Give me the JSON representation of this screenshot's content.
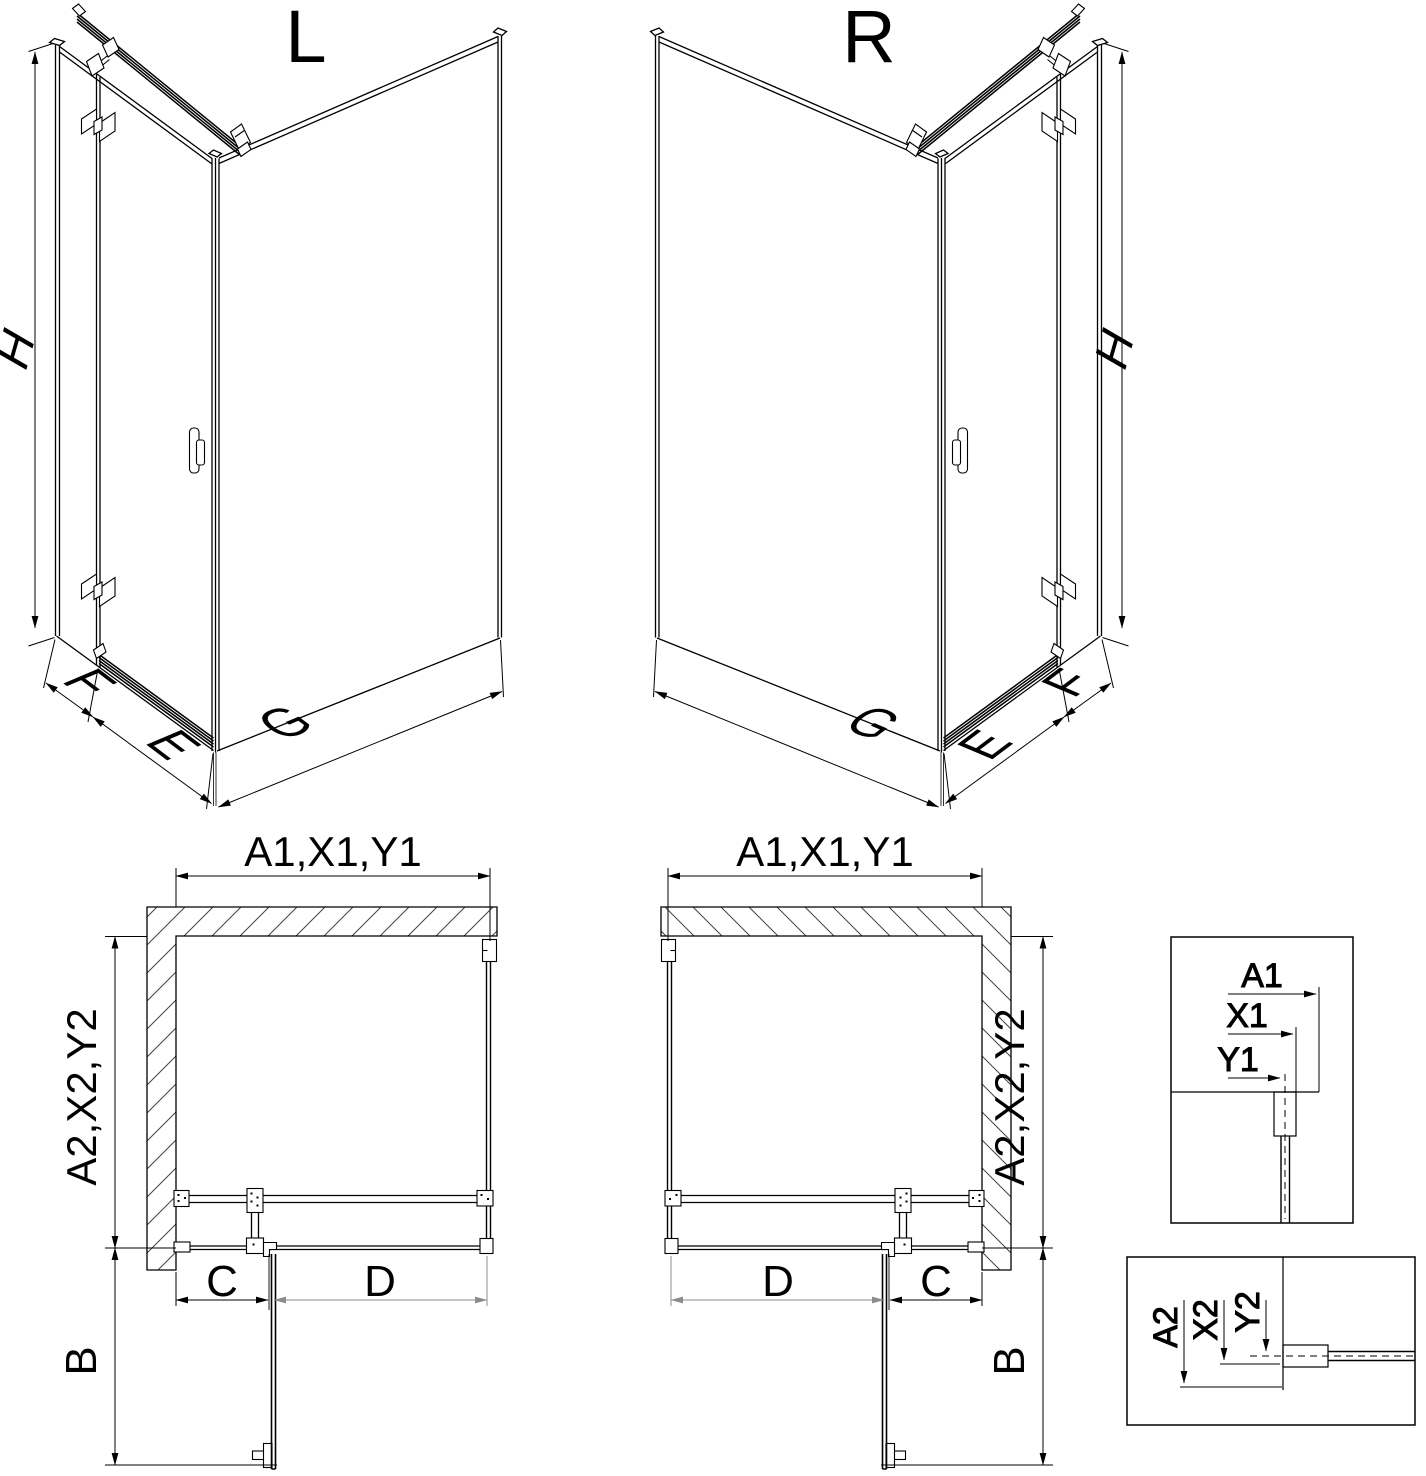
{
  "iso_left": {
    "title": "L",
    "h": "H",
    "f": "F",
    "e": "E",
    "g": "G"
  },
  "iso_right": {
    "title": "R",
    "h": "H",
    "f": "F",
    "e": "E",
    "g": "G"
  },
  "plan_left": {
    "top_dim": "A1,X1,Y1",
    "side_dim": "A2,X2,Y2",
    "c": "C",
    "d": "D",
    "b": "B"
  },
  "plan_right": {
    "top_dim": "A1,X1,Y1",
    "side_dim": "A2,X2,Y2",
    "c": "C",
    "d": "D",
    "b": "B"
  },
  "detail_top": {
    "a1": "A1",
    "x1": "X1",
    "y1": "Y1"
  },
  "detail_bottom": {
    "a2": "A2",
    "x2": "X2",
    "y2": "Y2"
  },
  "colors": {
    "line": "#000000",
    "dim_gray": "#8c8c8c",
    "background": "#ffffff"
  }
}
